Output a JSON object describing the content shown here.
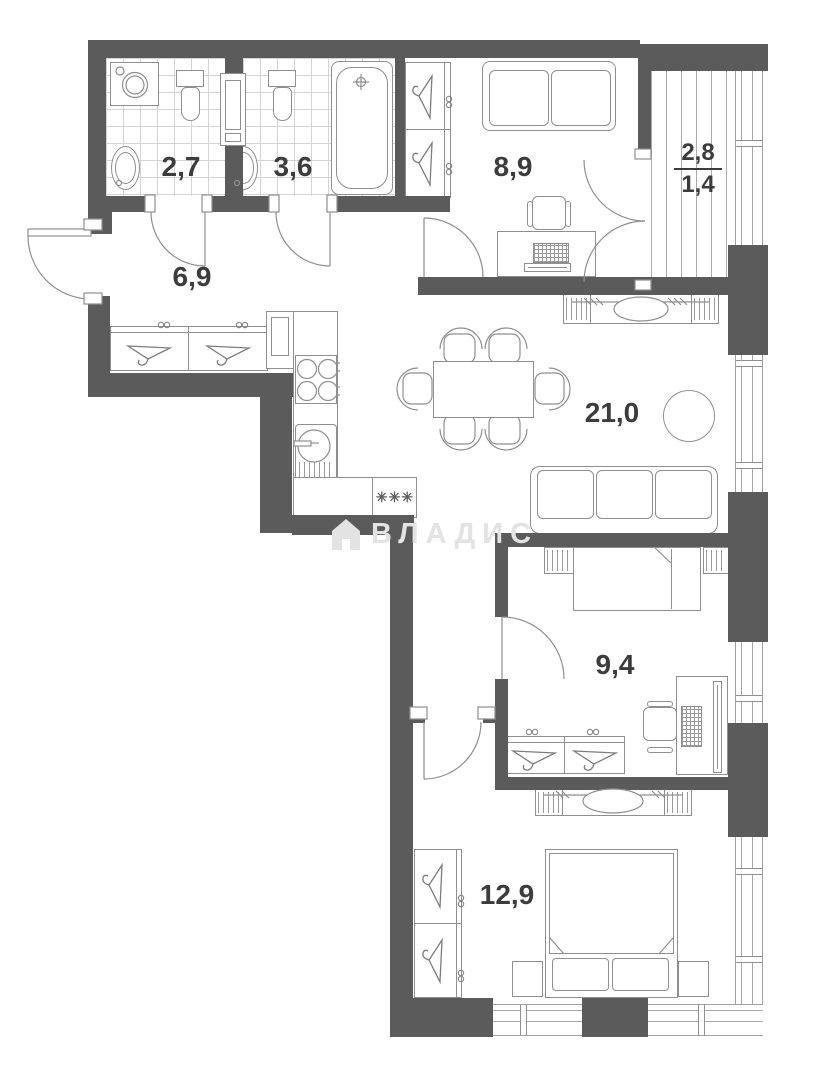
{
  "plan": {
    "title": "apartment-floor-plan",
    "watermark": {
      "text": "ВЛАДИС",
      "icon": "house-icon"
    },
    "rooms": [
      {
        "id": "bathroom-small",
        "area": "2,7"
      },
      {
        "id": "bathroom-large",
        "area": "3,6"
      },
      {
        "id": "hallway",
        "area": "6,9"
      },
      {
        "id": "bedroom-office",
        "area": "8,9"
      },
      {
        "id": "balcony",
        "area_full": "2,8",
        "area_reduced": "1,4"
      },
      {
        "id": "living-kitchen",
        "area": "21,0"
      },
      {
        "id": "bedroom-small",
        "area": "9,4"
      },
      {
        "id": "bedroom-master",
        "area": "12,9"
      }
    ],
    "markers": {
      "freezer": "✳✳✳"
    },
    "colors": {
      "wall": "#5b5b5b",
      "furniture_line": "#8f8f8f",
      "label": "#3c3c3c",
      "tile": "#d4d4d4",
      "glazing": "#a0a0a0",
      "watermark": "#e3e3e3"
    }
  }
}
